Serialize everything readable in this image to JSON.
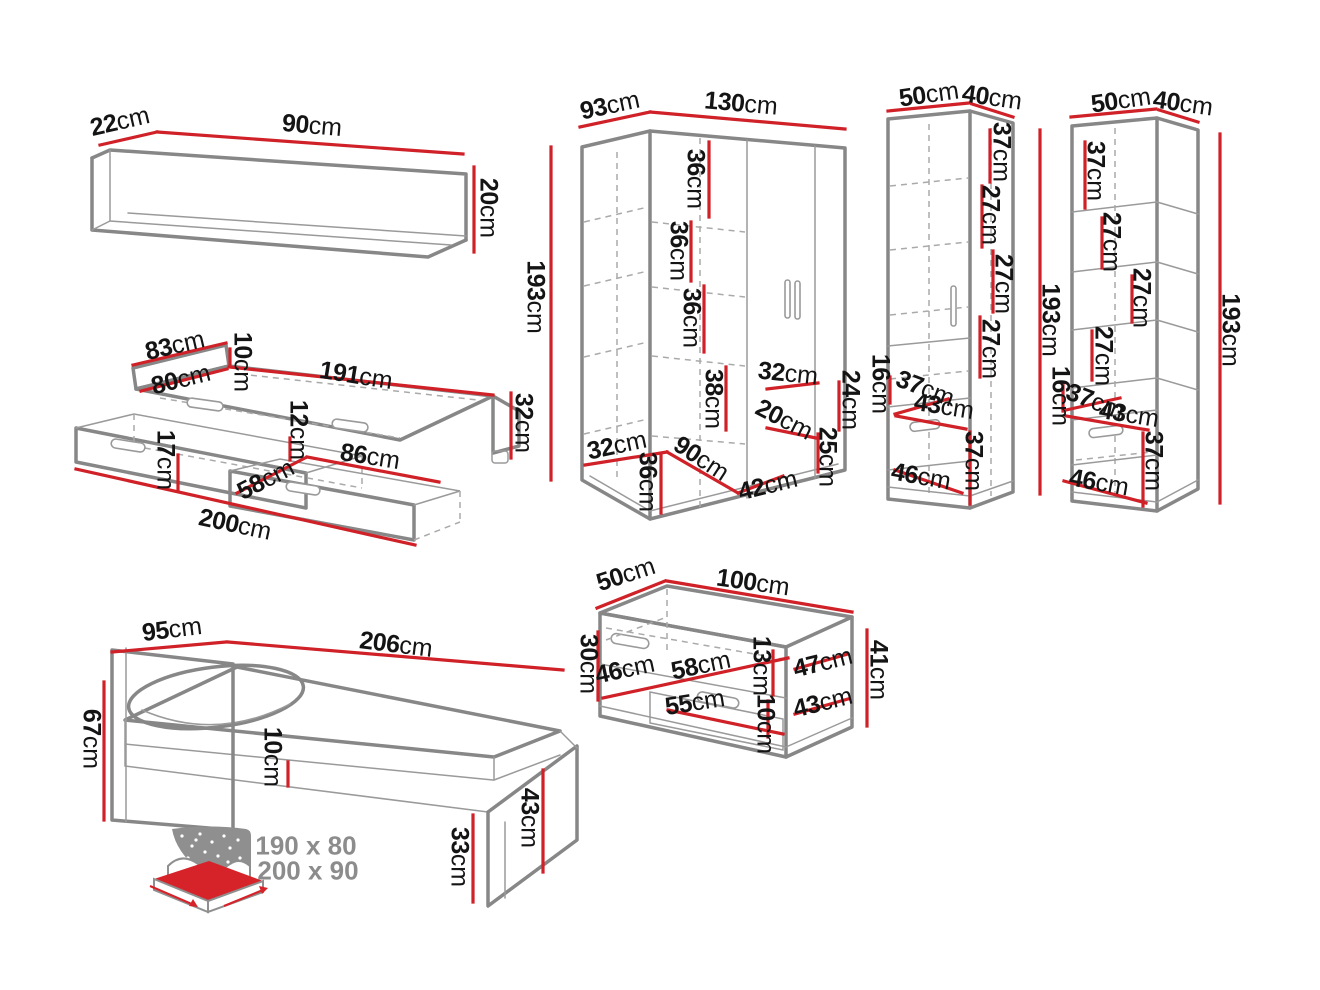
{
  "diagram_title": "Furniture set dimension drawing",
  "unit": "cm",
  "colors": {
    "dimension_line": "#cf2127",
    "furniture_outline": "#878787",
    "hidden_line": "#aaaaaa",
    "dim_text": "#141414",
    "muted_text": "#8c8c8c",
    "icon_mattress": "#d6232a"
  },
  "pieces": {
    "wall_shelf": {
      "depth": "22cm",
      "width": "90cm",
      "height": "20cm"
    },
    "trundle_bed": {
      "head_width": "83cm",
      "rail_height": "10cm",
      "inner_width": "80cm",
      "inner_length": "191cm",
      "frame_height": "32cm",
      "rim_height": "12cm",
      "drawer_front_width": "86cm",
      "drawer_depth": "17cm",
      "drawer_side": "58cm",
      "total_length": "200cm"
    },
    "corner_wardrobe": {
      "side_width": "93cm",
      "front_width": "130cm",
      "height": "193cm",
      "gap_top": "36cm",
      "gap_mid1": "36cm",
      "gap_mid2": "36cm",
      "gap_bottom": "38cm",
      "right_shelf_width": "32cm",
      "right_shelf_depth": "20cm",
      "right_gap_top": "24cm",
      "right_gap_bottom": "25cm",
      "base_side": "32cm",
      "base_height": "36cm",
      "base_diagonal": "90cm",
      "door_width": "42cm"
    },
    "wardrobe_cabinet": {
      "width": "50cm",
      "depth": "40cm",
      "gap1": "37cm",
      "gap2": "27cm",
      "gap3": "27cm",
      "gap4": "27cm",
      "height": "193cm",
      "niche_height": "16cm",
      "niche_depth": "37cm",
      "niche_width": "43cm",
      "lower_height": "37cm",
      "base_width": "46cm"
    },
    "bookcase": {
      "width": "50cm",
      "depth": "40cm",
      "gap1": "37cm",
      "gap2": "27cm",
      "gap3": "27cm",
      "gap4": "27cm",
      "height": "193cm",
      "niche_height": "16cm",
      "niche_depth": "37cm",
      "niche_width": "43cm",
      "lower_height": "37cm",
      "base_width": "46cm"
    },
    "bed": {
      "head_width": "95cm",
      "length": "206cm",
      "head_height": "67cm",
      "frame_height": "10cm",
      "foot_height": "43cm",
      "clearance": "33cm",
      "mattress_sizes": [
        "190 x 80",
        "200 x 90"
      ]
    },
    "chest": {
      "depth": "50cm",
      "width": "100cm",
      "side_height": "30cm",
      "inner_depth": "46cm",
      "inner_width": "58cm",
      "niche_height": "13cm",
      "top_depth": "47cm",
      "height": "41cm",
      "drawer_width": "55cm",
      "drawer_depth": "43cm",
      "drawer_height": "10cm"
    }
  }
}
